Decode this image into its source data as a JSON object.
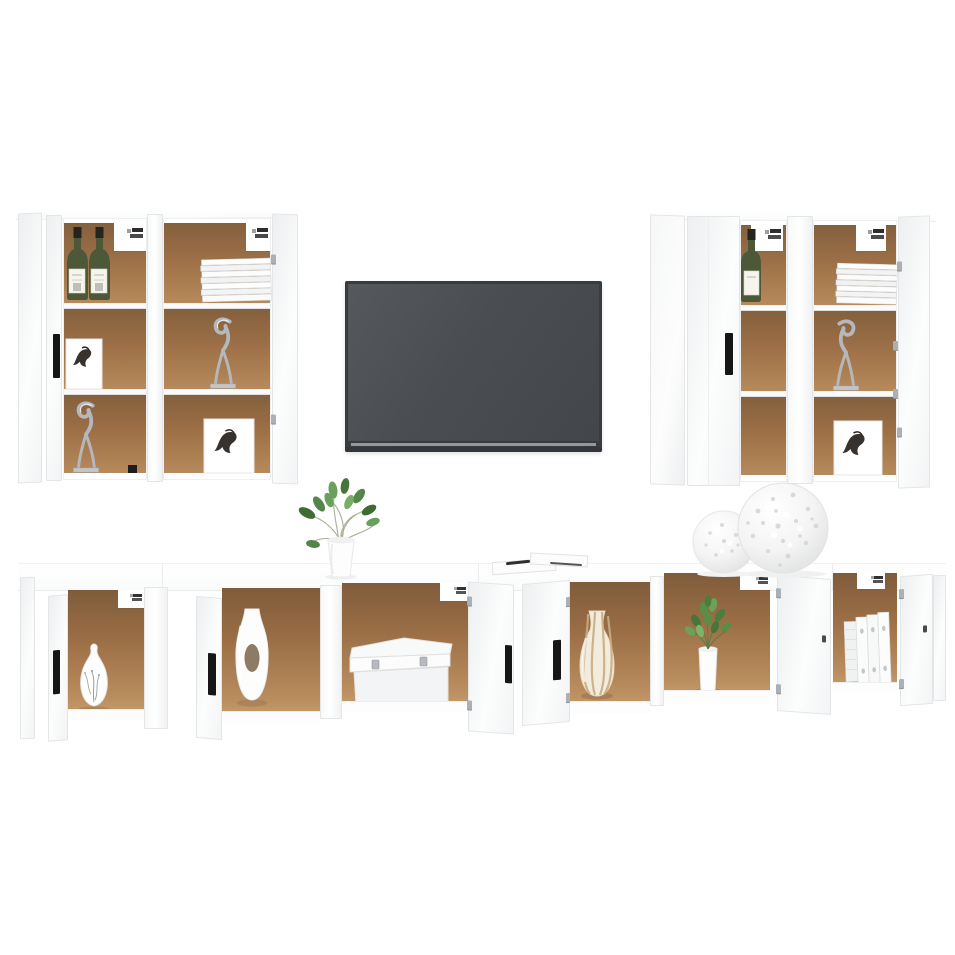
{
  "meta": {
    "type": "product-photo",
    "subject": "White wall-mounted TV furniture set: four tall wall cabinets, a flat-screen TV and a long low TV bench with open doors and decor"
  },
  "colors": {
    "panel": "#fcfdfd",
    "panelShade": "#edeff0",
    "border": "#e3e5e7",
    "interior": "#9c6f46",
    "interiorDark": "#84603e",
    "interiorLight": "#b68a5b",
    "shelf": "#fafafa",
    "handle": "#161616",
    "metal": "#b4b8bc",
    "tvFrame": "#383b40",
    "tvScreen": "#4a4d52",
    "tvStrip": "#94989d",
    "bottleGreen": "#4d5839",
    "bottleCap": "#23251f",
    "leaf": "#4e7d3f",
    "leafLight": "#74a45e",
    "stripeBeige": "#c7ad84",
    "sculpture": "#b4b8bc",
    "artInk": "#37322d"
  },
  "scene": {
    "wall_group_left": {
      "cabinet_1_contents": [
        "two green wine bottles",
        "horse sketch card",
        "silver cat sculpture"
      ],
      "cabinet_2_contents": [
        "stack of white magazines",
        "silver cat sculpture",
        "horse sketch card"
      ]
    },
    "tv": "dark grey flat-screen television",
    "wall_group_right": {
      "cabinet_3_contents": [
        "green wine bottle"
      ],
      "cabinet_4_contents": [
        "stack of white magazines",
        "silver cat sculpture",
        "horse sketch card"
      ]
    },
    "bench": {
      "compartments": [
        "white vase with branch motif",
        "tall white vase with oval cutout",
        "white storage box with clasps",
        "beige striped vase",
        "green plant in white pot",
        "white ring binders"
      ],
      "top_items": [
        "green plant in white pot",
        "papers with pen",
        "two white openwork decor spheres"
      ]
    }
  }
}
